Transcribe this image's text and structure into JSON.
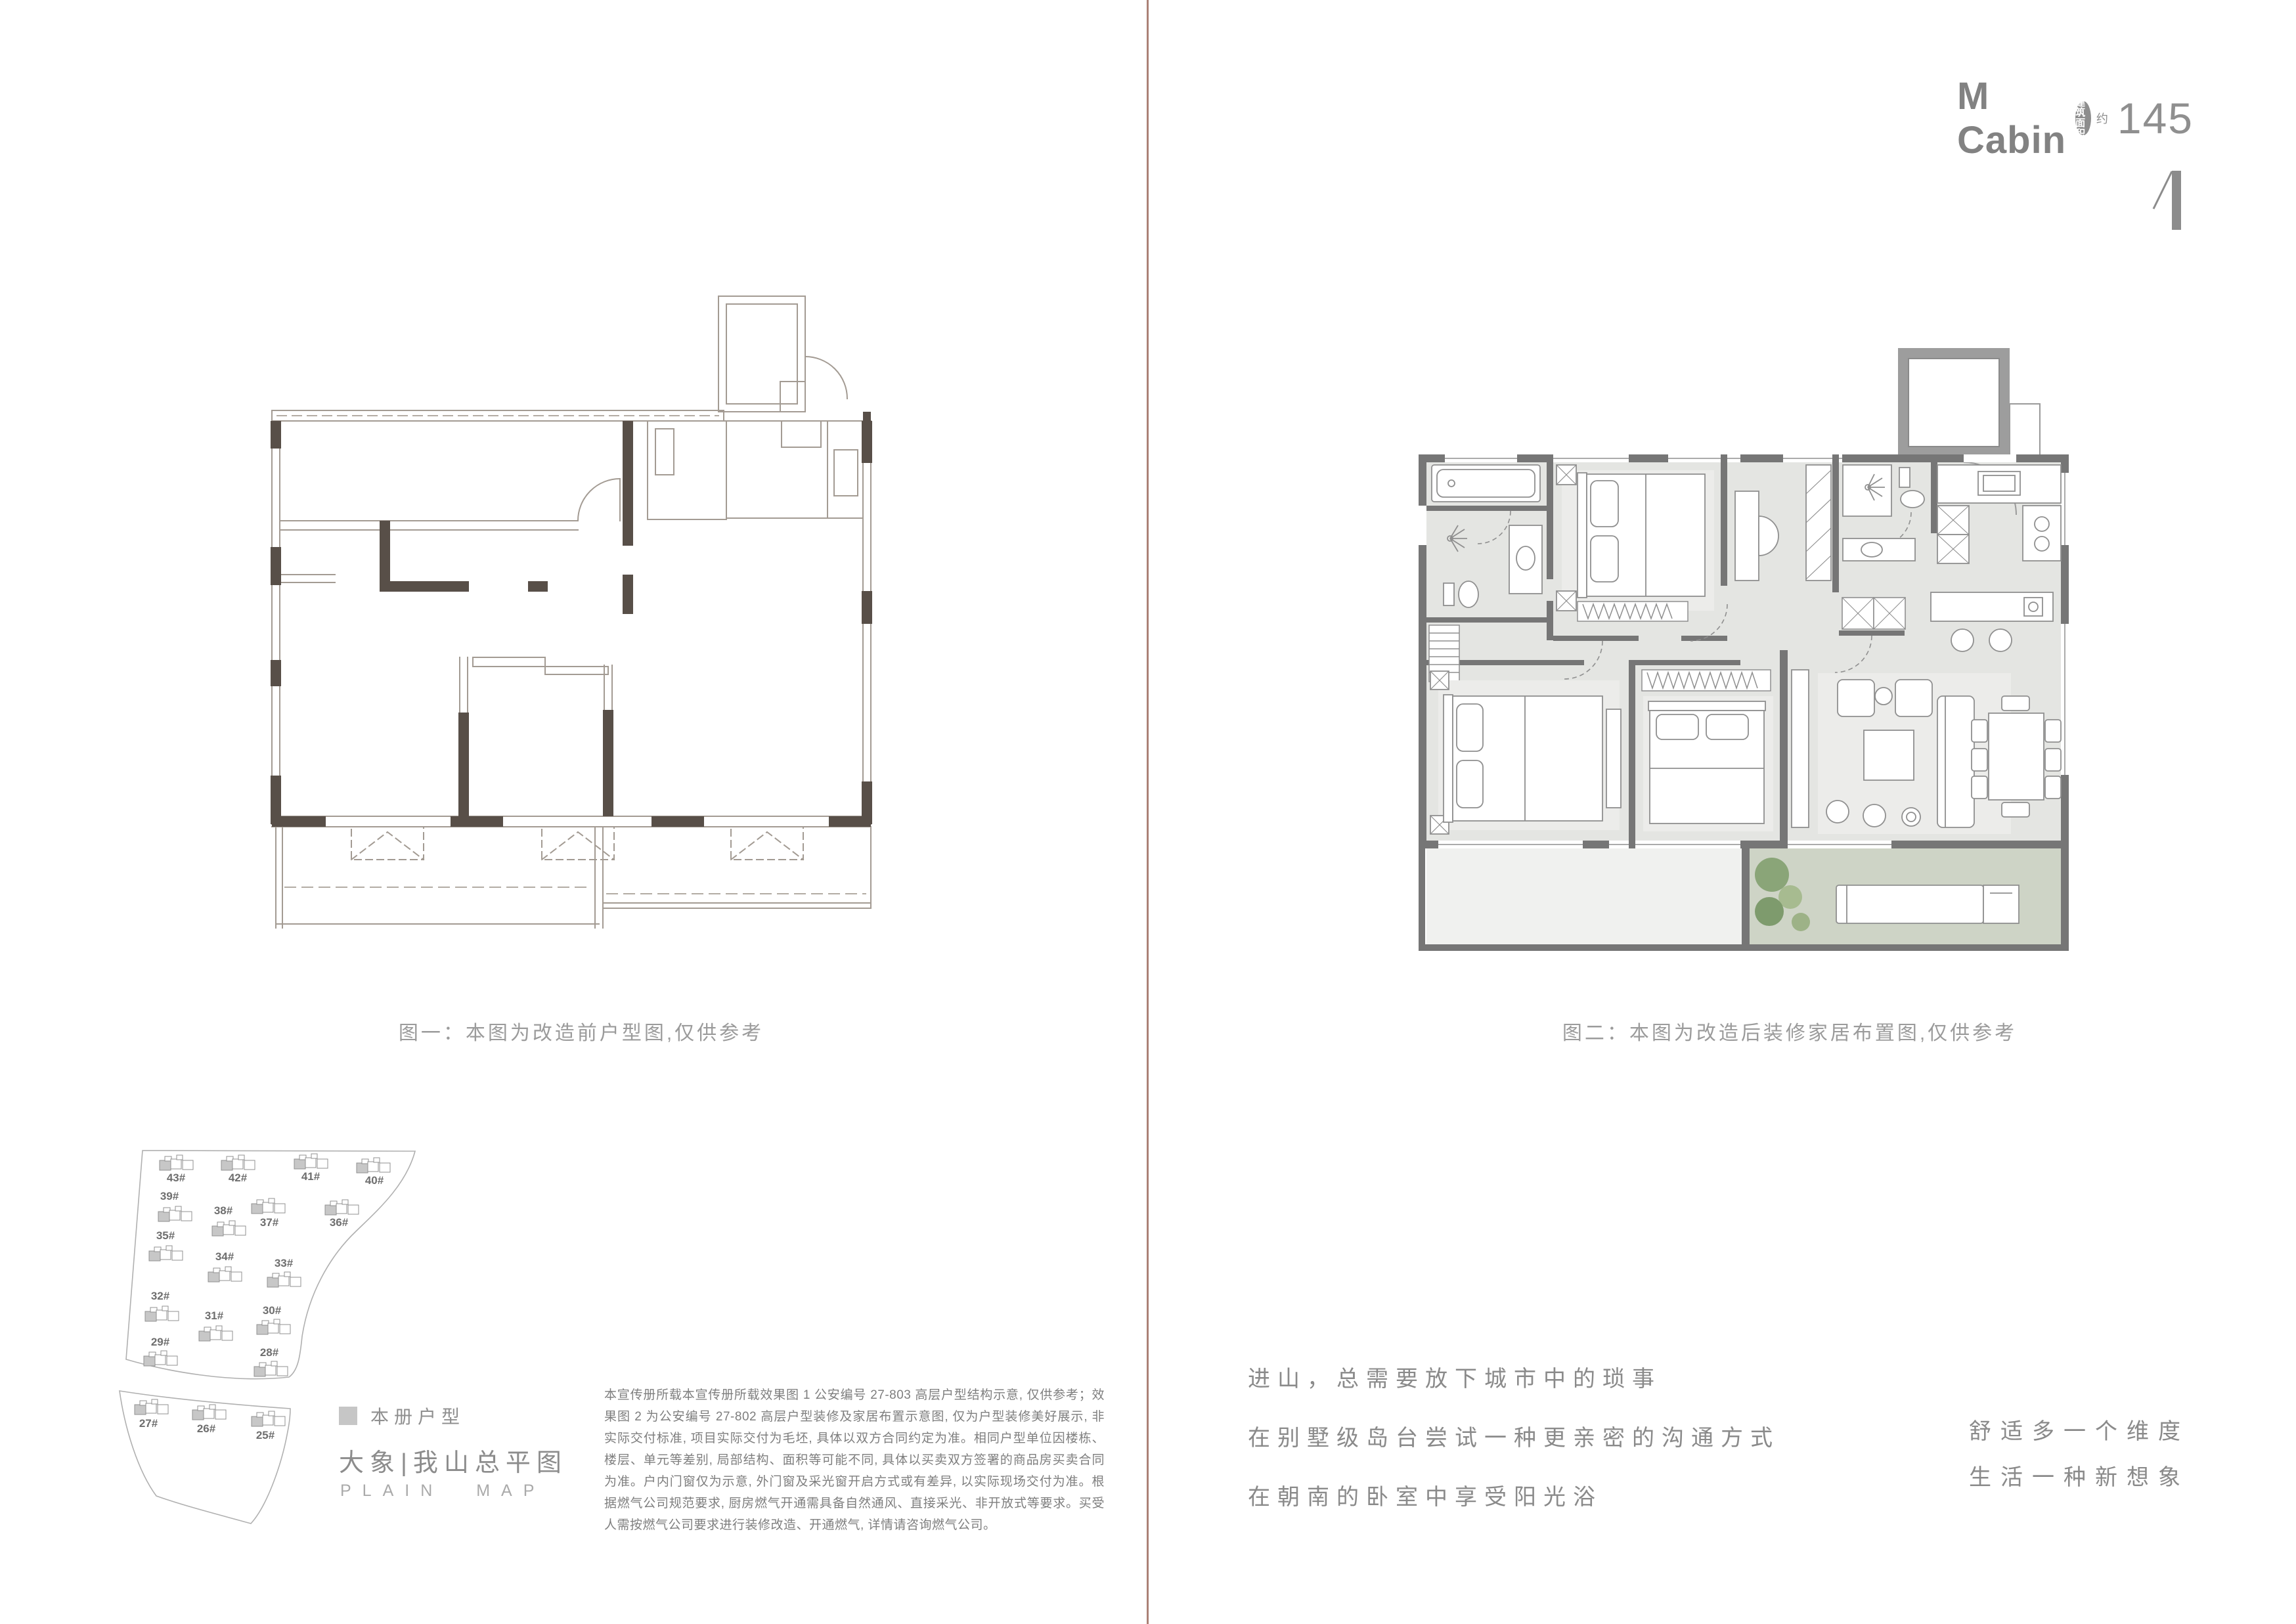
{
  "header": {
    "brand": "M Cabin",
    "badge_line1": "建筑",
    "badge_line2": "面积",
    "approx": "约",
    "area": "145",
    "page_mark": "1"
  },
  "left_page": {
    "figure1_caption": "图一：本图为改造前户型图,仅供参考",
    "sitemap": {
      "legend_label": "本册户型",
      "title": "大象|我山总平图",
      "subtitle": "PLAIN MAP",
      "buildings": [
        {
          "label": "43#"
        },
        {
          "label": "42#"
        },
        {
          "label": "41#"
        },
        {
          "label": "40#"
        },
        {
          "label": "39#"
        },
        {
          "label": "38#"
        },
        {
          "label": "37#"
        },
        {
          "label": "36#"
        },
        {
          "label": "35#"
        },
        {
          "label": "34#"
        },
        {
          "label": "33#"
        },
        {
          "label": "32#"
        },
        {
          "label": "31#"
        },
        {
          "label": "30#"
        },
        {
          "label": "29#"
        },
        {
          "label": "28#"
        },
        {
          "label": "27#"
        },
        {
          "label": "26#"
        },
        {
          "label": "25#"
        }
      ]
    },
    "disclaimer": "本宣传册所载本宣传册所载效果图 1 公安编号 27-803 高层户型结构示意, 仅供参考；效果图 2 为公安编号 27-802 高层户型装修及家居布置示意图, 仅为户型装修美好展示, 非实际交付标准, 项目实际交付为毛坯, 具体以双方合同约定为准。相同户型单位因楼栋、楼层、单元等差别, 局部结构、面积等可能不同, 具体以买卖双方签署的商品房买卖合同为准。户内门窗仅为示意, 外门窗及采光窗开启方式或有差异, 以实际现场交付为准。根据燃气公司规范要求, 厨房燃气开通需具备自然通风、直接采光、非开放式等要求。买受人需按燃气公司要求进行装修改造、开通燃气, 详情请咨询燃气公司。"
  },
  "right_page": {
    "figure2_caption": "图二：本图为改造后装修家居布置图,仅供参考",
    "body_lines": [
      "进山，总需要放下城市中的琐事",
      "在别墅级岛台尝试一种更亲密的沟通方式",
      "在朝南的卧室中享受阳光浴"
    ],
    "slogan_lines": [
      "舒适多一个维度",
      "生活一种新想象"
    ],
    "colors": {
      "wall": "#767676",
      "floor": "#e4e5e2",
      "balcony": "#ced4c6",
      "plant": "#8aa578",
      "divider": "#ab8277",
      "before_wall": "#584f48"
    }
  }
}
